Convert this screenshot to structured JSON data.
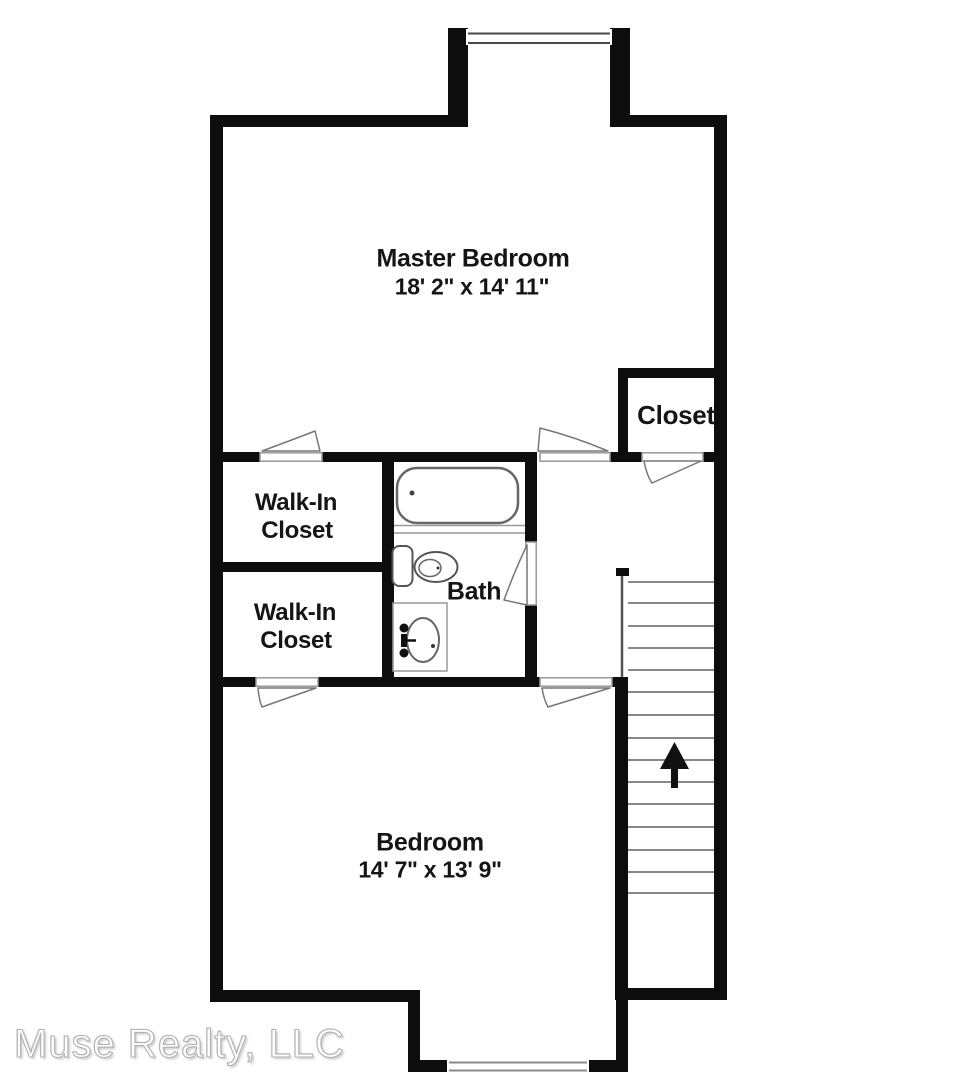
{
  "rooms": {
    "master_bedroom": {
      "label": "Master Bedroom",
      "dims": "18' 2\" x 14' 11\""
    },
    "walk_in_closet_1": {
      "line1": "Walk-In",
      "line2": "Closet"
    },
    "walk_in_closet_2": {
      "line1": "Walk-In",
      "line2": "Closet"
    },
    "bath": {
      "label": "Bath"
    },
    "closet": {
      "label": "Closet"
    },
    "bedroom": {
      "label": "Bedroom",
      "dims": "14' 7\" x 13' 9\""
    }
  },
  "stairs": {
    "direction_icon": "up-arrow"
  },
  "watermark": {
    "text": "Muse Realty, LLC"
  },
  "colors": {
    "wall": "#0d0d0d",
    "fixture_line": "#666666",
    "tread_line": "#777777",
    "text": "#151515",
    "watermark_stroke": "#b2b2b2"
  }
}
